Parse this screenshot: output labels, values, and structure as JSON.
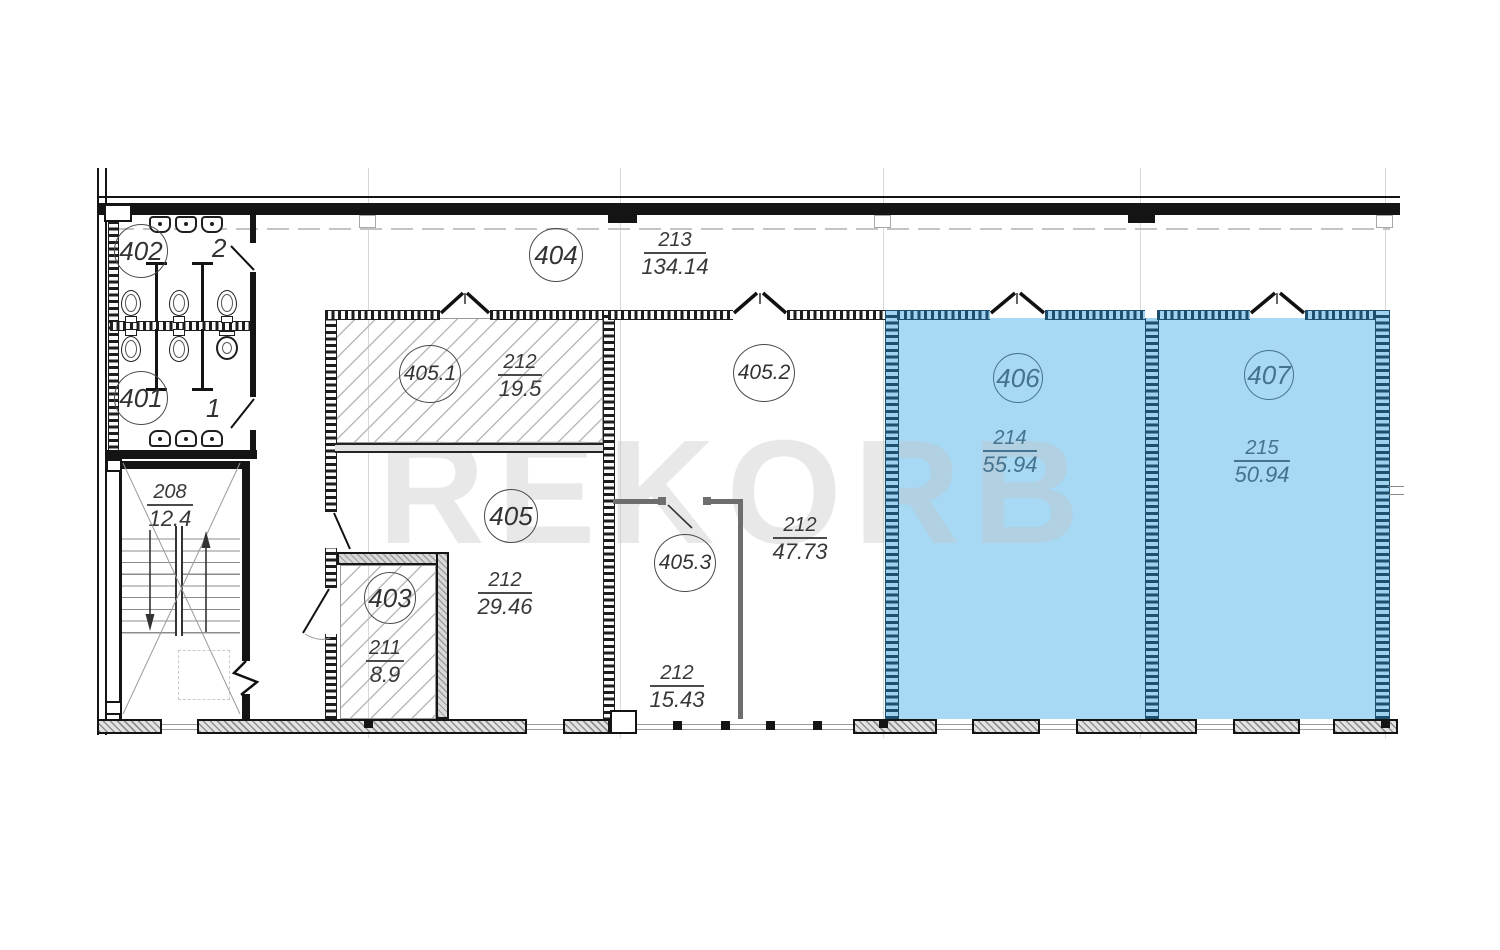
{
  "watermark": "REKORB",
  "colors": {
    "highlight_fill": "#a7d8f4",
    "highlight_text": "#44738f"
  },
  "corridor": {
    "number": "404",
    "code": "213",
    "area": "134.14"
  },
  "stairwell": {
    "code": "208",
    "area": "12.4"
  },
  "restrooms": {
    "upper": {
      "number": "402"
    },
    "lower": {
      "number": "401"
    },
    "stall_upper": "2",
    "stall_lower": "1"
  },
  "rooms": {
    "r405_1": {
      "number": "405.1",
      "code": "212",
      "area": "19.5",
      "highlighted": false
    },
    "r405_2": {
      "number": "405.2",
      "code": "212",
      "area": "47.73",
      "highlighted": false
    },
    "r405": {
      "number": "405",
      "code": "212",
      "area": "29.46",
      "highlighted": false
    },
    "r405_3": {
      "number": "405.3",
      "code": "212",
      "area": "15.43",
      "highlighted": false
    },
    "r403": {
      "number": "403",
      "code": "211",
      "area": "8.9",
      "highlighted": false
    },
    "r406": {
      "number": "406",
      "code": "214",
      "area": "55.94",
      "highlighted": true
    },
    "r407": {
      "number": "407",
      "code": "215",
      "area": "50.94",
      "highlighted": true
    }
  }
}
